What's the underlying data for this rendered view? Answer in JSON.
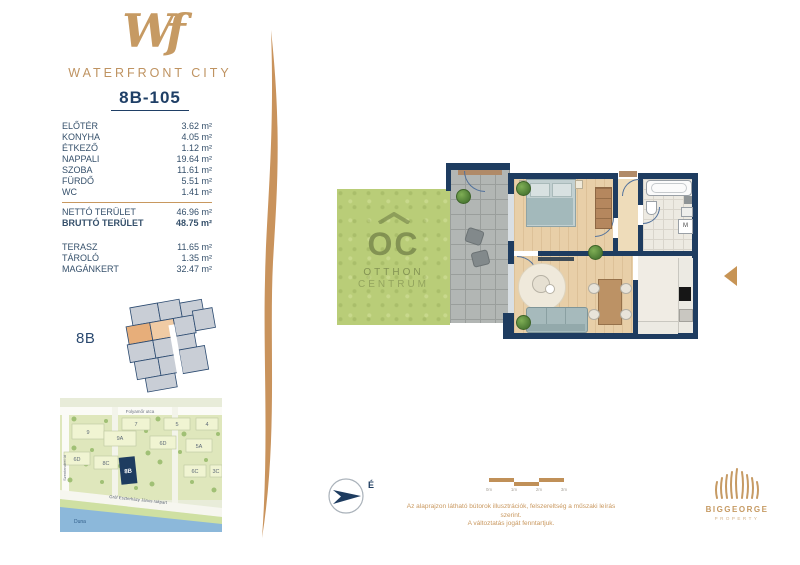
{
  "brand": {
    "monogram": "Wf",
    "name": "WATERFRONT CITY"
  },
  "unit": {
    "id": "8B-105"
  },
  "rooms": [
    {
      "label": "ELŐTÉR",
      "area": "3.62 m²"
    },
    {
      "label": "KONYHA",
      "area": "4.05 m²"
    },
    {
      "label": "ÉTKEZŐ",
      "area": "1.12 m²"
    },
    {
      "label": "NAPPALI",
      "area": "19.64 m²"
    },
    {
      "label": "SZOBA",
      "area": "11.61 m²"
    },
    {
      "label": "FÜRDŐ",
      "area": "5.51 m²"
    },
    {
      "label": "WC",
      "area": "1.41 m²"
    }
  ],
  "totals": [
    {
      "label": "NETTÓ TERÜLET",
      "area": "46.96 m²"
    },
    {
      "label": "BRUTTÓ TERÜLET",
      "area": "48.75 m²"
    }
  ],
  "extras": [
    {
      "label": "TERASZ",
      "area": "11.65 m²"
    },
    {
      "label": "TÁROLÓ",
      "area": "1.35 m²"
    },
    {
      "label": "MAGÁNKERT",
      "area": "32.47 m²"
    }
  ],
  "keyplan": {
    "label": "8B"
  },
  "map": {
    "street_top": "Folyamőr utca",
    "street_left": "Szentendrei út",
    "street_quay": "Gróf Eszterházy János rakpart",
    "river": "Duna",
    "highlight": "8B",
    "blocks": [
      "7",
      "5",
      "4",
      "9",
      "9A",
      "6D",
      "5A",
      "6D",
      "8C",
      "6C",
      "3C"
    ]
  },
  "plan": {
    "watermark": {
      "monogram": "OC",
      "line1": "OTTHON",
      "line2": "CENTRUM"
    },
    "washer_label": "M",
    "compass_label": "É"
  },
  "scalebar": {
    "ticks": [
      "0m",
      "1m",
      "2m",
      "3m"
    ]
  },
  "disclaimer": {
    "line1": "Az alaprajzon látható bútorok illusztrációk, felszereltség a műszaki leírás szerint.",
    "line2": "A változtatás jogát fenntartjuk."
  },
  "developer": {
    "name": "BIGGEORGE",
    "subtitle": "PROPERTY"
  },
  "colors": {
    "accent_tan": "#c69a63",
    "navy": "#1e3c60",
    "garden_green": "#b9cd78",
    "river_blue": "#8cb8da"
  }
}
